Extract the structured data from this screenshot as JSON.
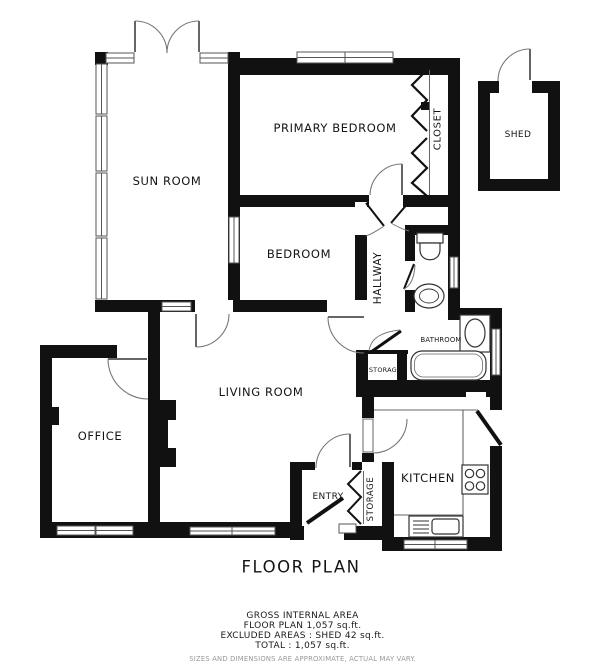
{
  "plan": {
    "title": "FLOOR PLAN",
    "labels": {
      "sun_room": "SUN ROOM",
      "primary_bedroom": "PRIMARY BEDROOM",
      "closet": "CLOSET",
      "shed": "SHED",
      "bedroom": "BEDROOM",
      "hallway": "HALLWAY",
      "bathroom": "BATHROOM",
      "storage_hall": "STORAGE",
      "living_room": "LIVING ROOM",
      "office": "OFFICE",
      "kitchen": "KITCHEN",
      "entry": "ENTRY",
      "storage_entry": "STORAGE"
    }
  },
  "footer": {
    "area_heading": "GROSS INTERNAL AREA",
    "floor_plan_area": "FLOOR PLAN 1,057 sq.ft.",
    "excluded_areas": "EXCLUDED AREAS :  SHED 42 sq.ft.",
    "total": "TOTAL :  1,057 sq.ft.",
    "disclaimer": "SIZES AND DIMENSIONS ARE APPROXIMATE, ACTUAL MAY VARY."
  },
  "colors": {
    "wall": "#111111",
    "line": "#555555",
    "text": "#141414",
    "muted": "#999999"
  }
}
